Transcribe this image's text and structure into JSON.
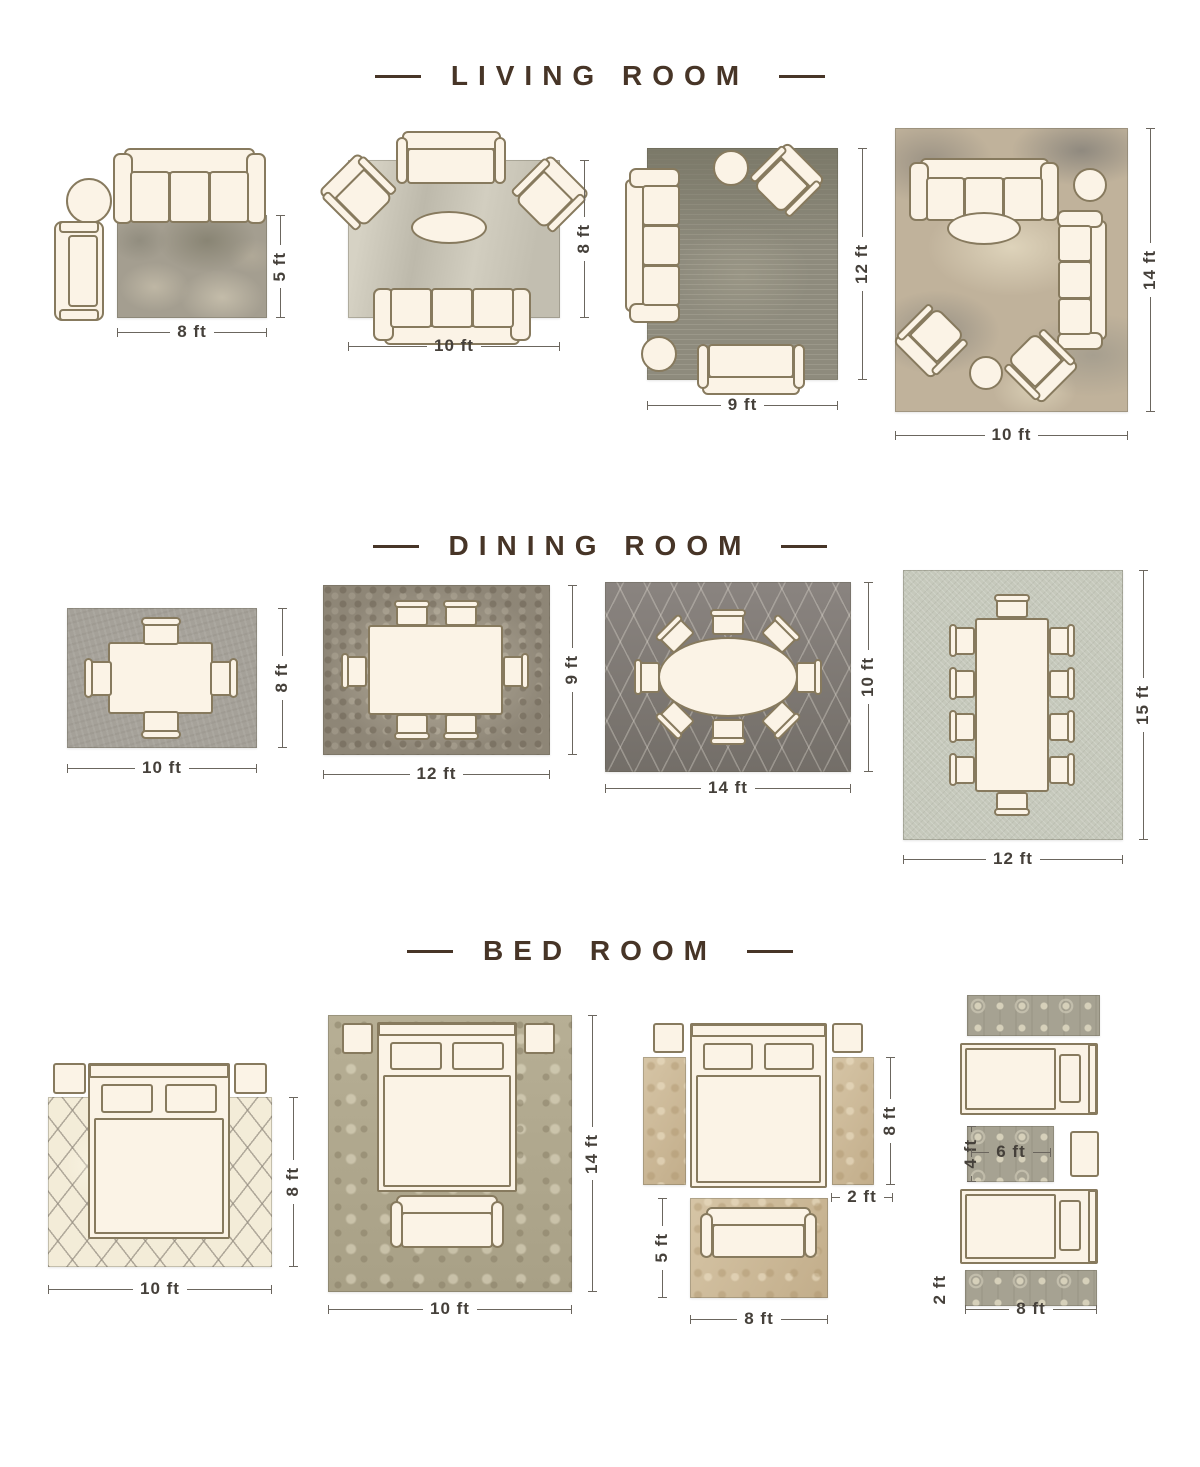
{
  "sections": {
    "living": {
      "title": "LIVING ROOM"
    },
    "dining": {
      "title": "DINING ROOM"
    },
    "bed": {
      "title": "BED ROOM"
    }
  },
  "dims": {
    "lr1": {
      "w": "8 ft",
      "h": "5 ft"
    },
    "lr2": {
      "w": "10 ft",
      "h": "8 ft"
    },
    "lr3": {
      "w": "9 ft",
      "h": "12 ft"
    },
    "lr4": {
      "w": "10 ft",
      "h": "14 ft"
    },
    "dr1": {
      "w": "10 ft",
      "h": "8 ft"
    },
    "dr2": {
      "w": "12 ft",
      "h": "9 ft"
    },
    "dr3": {
      "w": "14 ft",
      "h": "10 ft"
    },
    "dr4": {
      "w": "12 ft",
      "h": "15 ft"
    },
    "br1": {
      "w": "10 ft",
      "h": "8 ft"
    },
    "br2": {
      "w": "10 ft",
      "h": "14 ft"
    },
    "br3": {
      "w": "8 ft",
      "h": "5 ft",
      "runner_h": "8 ft",
      "runner_w": "2 ft"
    },
    "br4": {
      "w": "8 ft",
      "runner_w": "2 ft",
      "small_w": "6 ft",
      "small_h": "4 ft"
    }
  },
  "colors": {
    "title_text": "#473527",
    "dimension_text": "#45403a",
    "furniture_fill": "#fbf3e6",
    "furniture_outline": "#877a5e"
  }
}
